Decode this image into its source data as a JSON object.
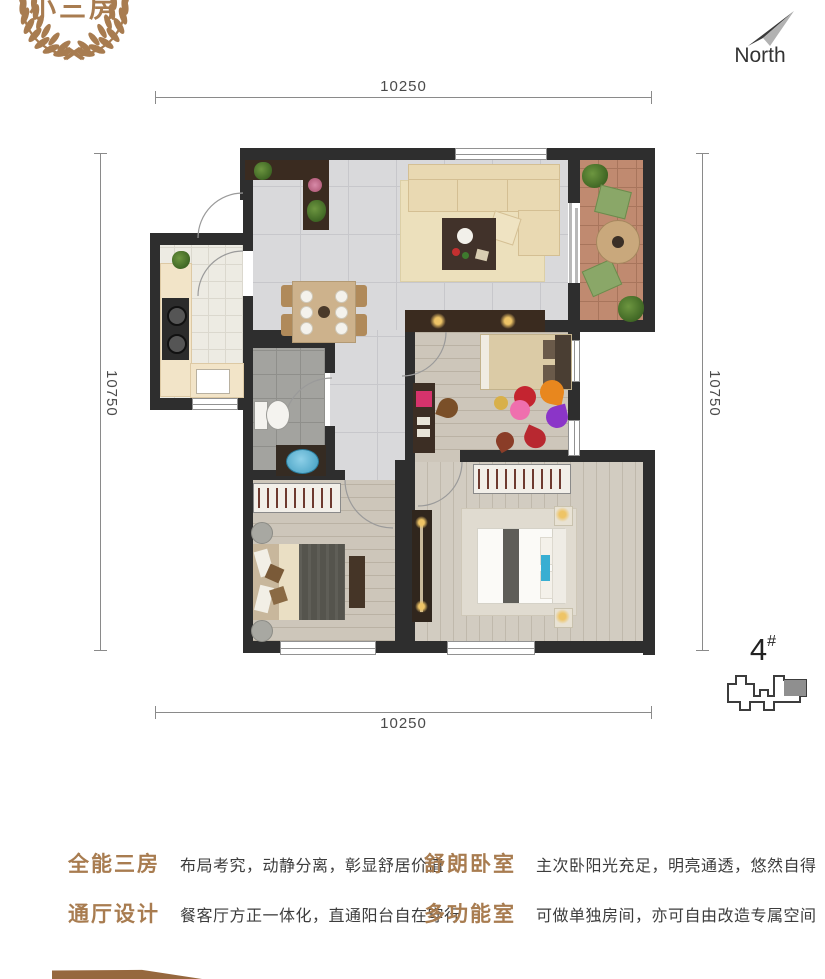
{
  "logo": {
    "text": "小三房"
  },
  "compass": {
    "label": "North"
  },
  "dimensions": {
    "top": "10250",
    "bottom": "10250",
    "left": "10750",
    "right": "10750"
  },
  "unit_marker": {
    "number": "4",
    "suffix": "#"
  },
  "features": [
    {
      "title": "全能三房",
      "desc": "布局考究，动静分离，彰显舒居价值"
    },
    {
      "title": "舒朗卧室",
      "desc": "主次卧阳光充足，明亮通透，悠然自得"
    },
    {
      "title": "通厅设计",
      "desc": "餐客厅方正一体化，直通阳台自在穿行"
    },
    {
      "title": "多功能室",
      "desc": "可做单独房间，亦可自由改造专属空间"
    }
  ],
  "colors": {
    "accent": "#a87c50",
    "text_dark": "#3d3d3d",
    "wall": "#2e2e2e",
    "dimension_line": "#8a8a8a"
  }
}
